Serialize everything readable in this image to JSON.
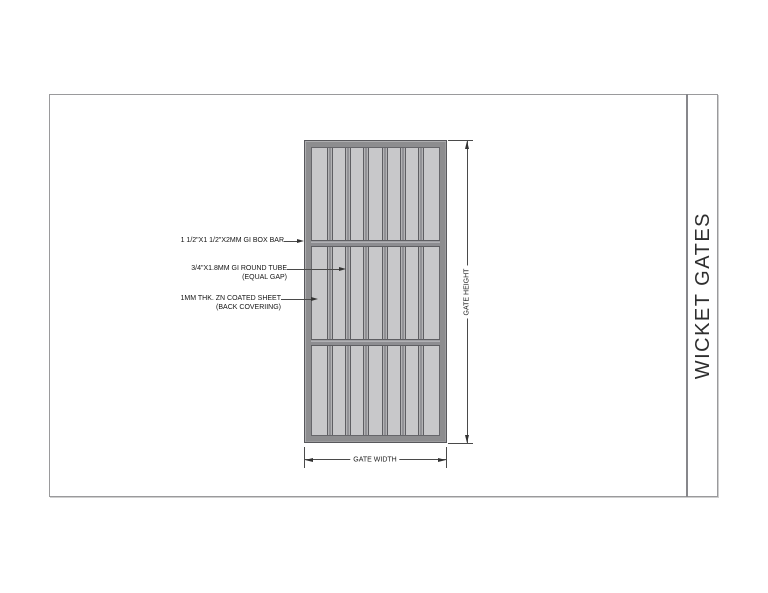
{
  "title_block": {
    "title": "WICKET GATES"
  },
  "dimensions": {
    "height_label": "GATE HEIGHT",
    "width_label": "GATE WIDTH"
  },
  "annotations": [
    {
      "line1": "1 1/2\"X1 1/2\"X2MM GI BOX BAR"
    },
    {
      "line1": "3/4\"X1.8MM GI ROUND TUBE",
      "line2": "(EQUAL GAP)"
    },
    {
      "line1": "1MM THK. ZN COATED SHEET",
      "line2": "(BACK COVERIING)"
    }
  ],
  "gate": {
    "vertical_tube_count": 6,
    "horizontal_bar_count": 2,
    "section_count": 3,
    "colors": {
      "frame_fill": "#8d8d8f",
      "frame_edge": "#58585c",
      "sheet_fill": "#c8c8ca",
      "tube_fill": "#929296",
      "tube_edge": "#5e5e62",
      "tube_highlight": "#b3b3b5",
      "bar_fill": "#8d8d91"
    }
  }
}
